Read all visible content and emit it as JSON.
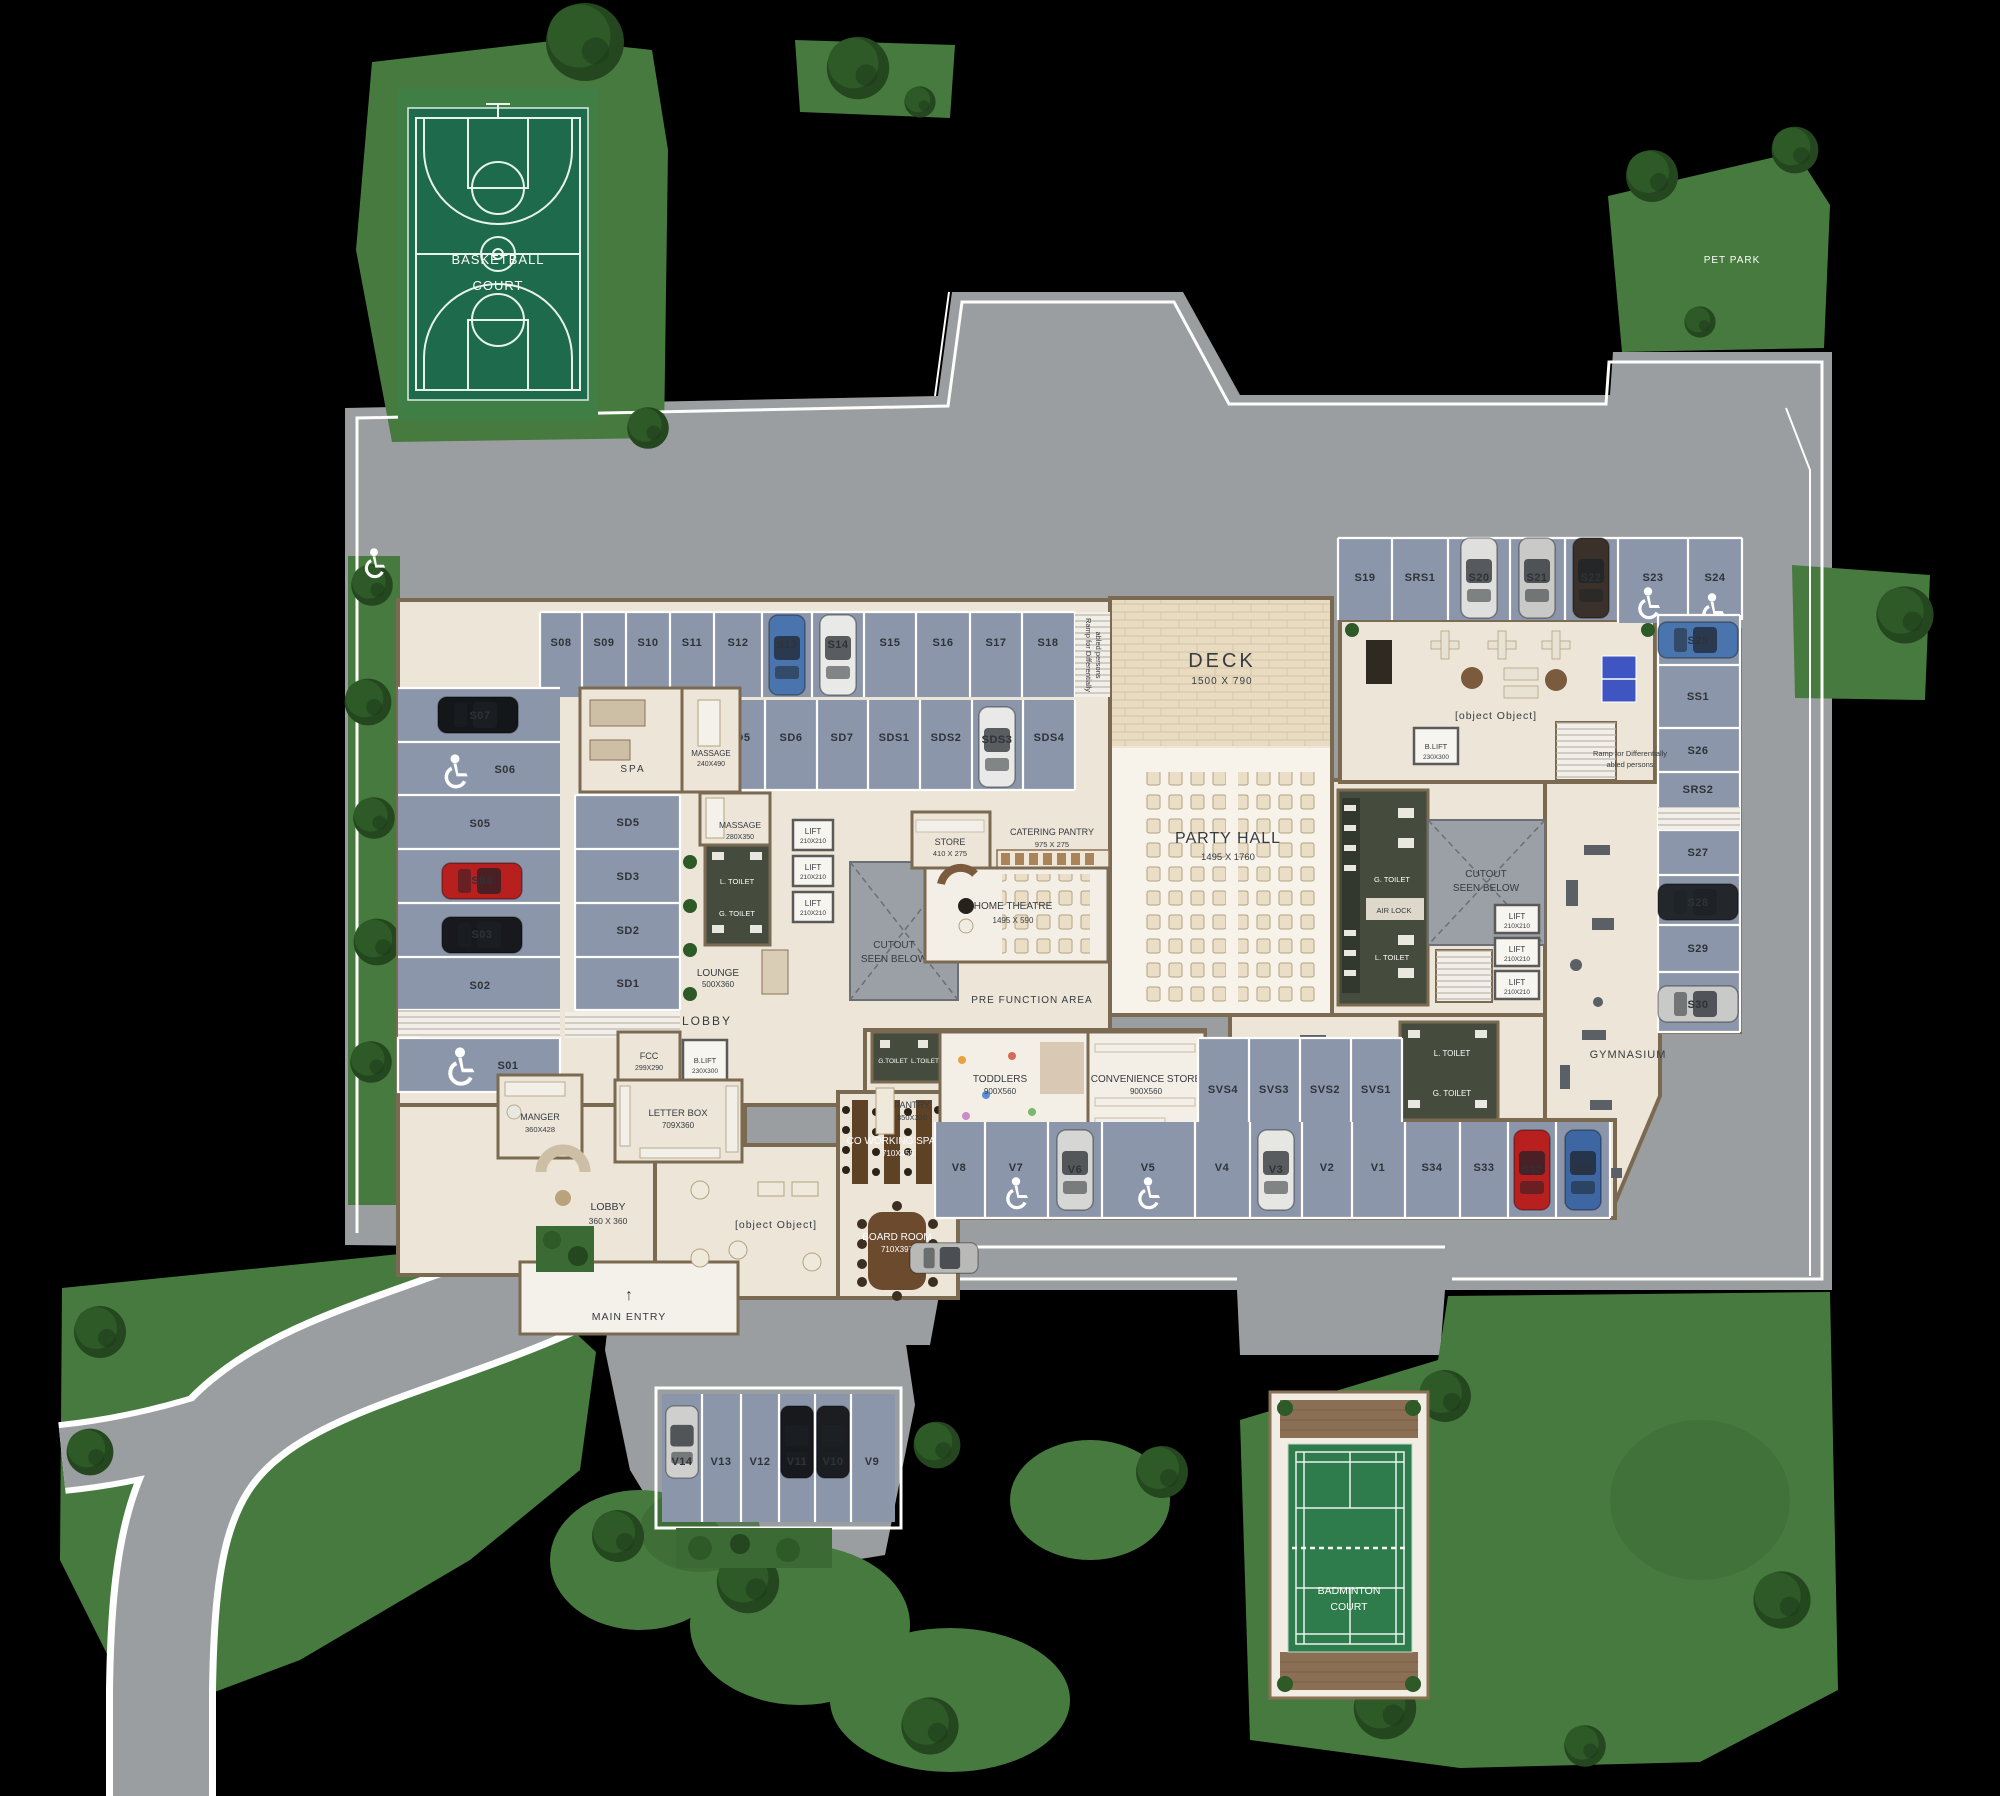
{
  "site": {
    "basketball_court": {
      "line1": "BASKETBALL",
      "line2": "COURT"
    },
    "pet_park": {
      "label": "PET PARK"
    },
    "badminton_court": {
      "line1": "BADMINTON",
      "line2": "COURT"
    },
    "main_entry": {
      "arrow": "↑",
      "label": "MAIN ENTRY"
    },
    "ramp_note": {
      "line1": "Ramp for Differentially",
      "line2": "abled persons"
    }
  },
  "rooms": {
    "spa": {
      "name": "SPA"
    },
    "massage_upper": {
      "name": "MASSAGE",
      "dims": "240X490"
    },
    "massage_lower": {
      "name": "MASSAGE",
      "dims": "280X350"
    },
    "l_toilet": {
      "name": "L. TOILET"
    },
    "g_toilet": {
      "name": "G. TOILET"
    },
    "l_toilet_small": {
      "name": "L.TOILET"
    },
    "g_toilet_small": {
      "name": "G.TOILET"
    },
    "air_lock": {
      "name": "AIR LOCK"
    },
    "lift": {
      "name": "LIFT",
      "dims": "210X210"
    },
    "b_lift": {
      "name": "B.LIFT",
      "dims": "230X300"
    },
    "cutout": {
      "line1": "CUTOUT",
      "line2": "SEEN BELOW"
    },
    "lounge": {
      "name": "LOUNGE",
      "dims": "500X360"
    },
    "lobby_upper": {
      "name": "LOBBY"
    },
    "lobby_main": {
      "name": "LOBBY",
      "dims": "360 X 360"
    },
    "fcc": {
      "name": "FCC",
      "dims": "299X290"
    },
    "manger": {
      "name": "MANGER",
      "dims": "360X428"
    },
    "letter_box": {
      "name": "LETTER BOX",
      "dims": "709X360"
    },
    "store": {
      "name": "STORE",
      "dims": "410 X 275"
    },
    "catering_pantry": {
      "name": "CATERING PANTRY",
      "dims": "975 X 275"
    },
    "home_theatre": {
      "name": "HOME THEATRE",
      "dims": "1495 X 590"
    },
    "party_hall": {
      "name": "PARTY HALL",
      "dims": "1495 X 1760"
    },
    "deck": {
      "name": "DECK",
      "dims": "1500 X 790"
    },
    "pre_function": {
      "name": "PRE FUNCTION AREA"
    },
    "recreational": {
      "name": "RECREATIONAL SPACE / GAMES ROOM"
    },
    "gymnasium": {
      "name": "GYMNASIUM"
    },
    "pantry": {
      "name": "PANTRY",
      "dims": "350X320"
    },
    "toddlers": {
      "name": "TODDLERS",
      "dims": "900X560"
    },
    "co_working": {
      "name": "CO WORKING SPACE",
      "dims": "710X455"
    },
    "board_room": {
      "name": "BOARD ROOM",
      "dims": "710X397"
    },
    "convenience_store": {
      "name": "CONVENIENCE STORE",
      "dims": "900X560"
    },
    "lounge_seating": {
      "name": "LOUNGE SEATING"
    }
  },
  "parking": {
    "row_top": [
      "S08",
      "S09",
      "S10",
      "S11",
      "S12",
      "S13",
      "S14",
      "S15",
      "S16",
      "S17",
      "S18"
    ],
    "row_mid": [
      "SD5",
      "SD6",
      "SD7",
      "SDS1",
      "SDS2",
      "SDS3",
      "SDS4"
    ],
    "col_left": [
      "S07",
      "S06",
      "S05",
      "S04",
      "S03",
      "S02",
      "S01"
    ],
    "col_sd": [
      "SD5",
      "SD3",
      "SD2",
      "SD1"
    ],
    "row_top_right": [
      "S19",
      "SRS1",
      "S20",
      "S21",
      "S22",
      "S23",
      "S24"
    ],
    "col_right": [
      "S25",
      "SS1",
      "S26",
      "SRS2",
      "S27",
      "S28",
      "S29",
      "S30"
    ],
    "row_svs": [
      "SVS4",
      "SVS3",
      "SVS2",
      "SVS1"
    ],
    "row_bottom": [
      "V8",
      "V7",
      "V6",
      "V5",
      "V4",
      "V3",
      "V2",
      "V1",
      "S34",
      "S33",
      "S32",
      "S31"
    ],
    "island": [
      "V14",
      "V13",
      "V12",
      "V11",
      "V10",
      "V9"
    ]
  },
  "colors": {
    "background": "#000000",
    "asphalt": "#9b9ea1",
    "stall_blue": "#8c96aa",
    "floor_cream": "#ece5d8",
    "wall_brown": "#7b6a52",
    "grass": "#477a3e",
    "court_green": "#1e6a4d",
    "badminton_green": "#2e7c4b",
    "toilet_olive": "#454c3e",
    "table_tennis_blue": "#3f55c1",
    "car_red": "#b81f1f",
    "car_blue": "#4a74ad"
  }
}
